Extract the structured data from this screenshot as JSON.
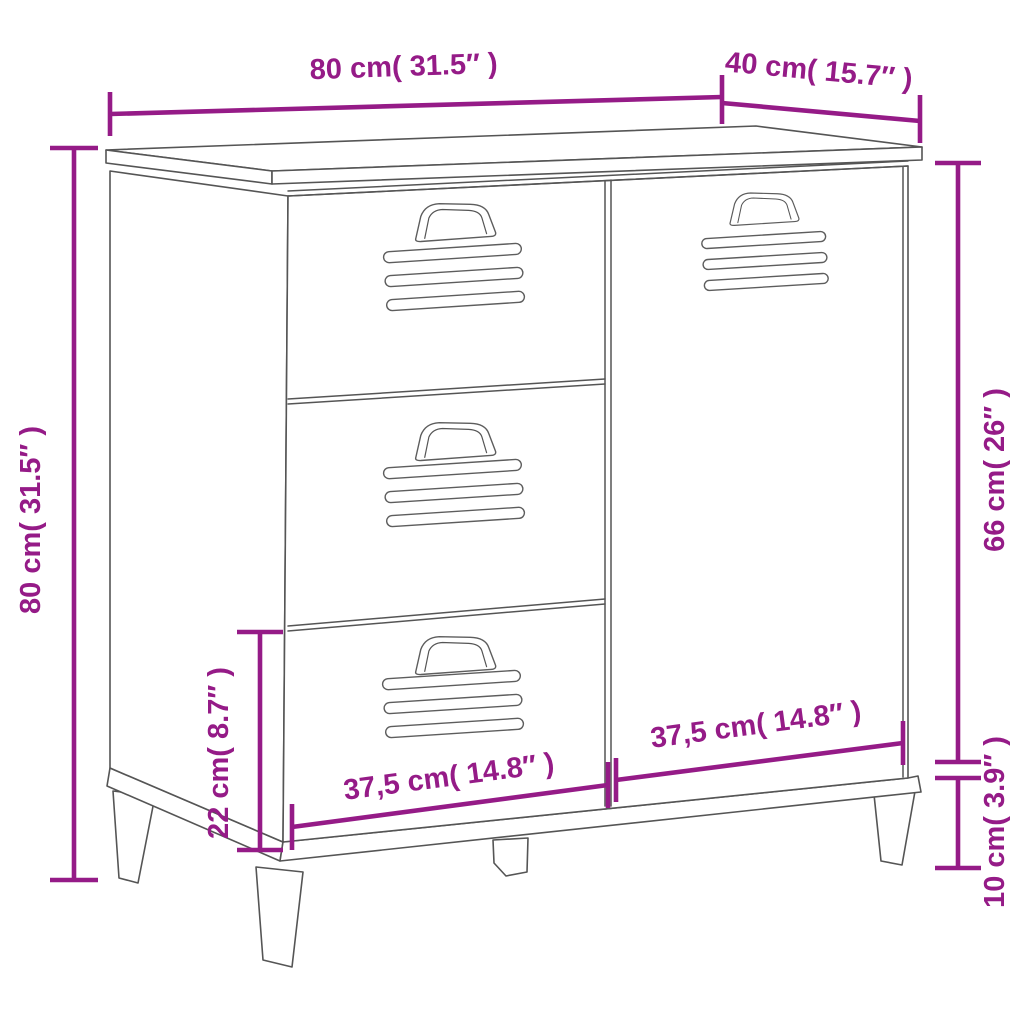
{
  "page": {
    "title": "Cabinet dimension diagram",
    "background_color": "#ffffff",
    "accent_color": "#951B87",
    "line_color": "#555555"
  },
  "product": {
    "description": "Industrial sideboard line drawing with three vented drawers on the left, one vented door on the right, and four splayed legs"
  },
  "dimensions": {
    "top_width": {
      "label": "80 cm( 31.5″ )",
      "cm": "80",
      "inch": "31.5"
    },
    "top_depth": {
      "label": "40 cm( 15.7″ )",
      "cm": "40",
      "inch": "15.7"
    },
    "left_height": {
      "label": "80 cm( 31.5″ )",
      "cm": "80",
      "inch": "31.5"
    },
    "right_upper_height": {
      "label": "66 cm( 26″ )",
      "cm": "66",
      "inch": "26"
    },
    "right_leg_height": {
      "label": "10 cm( 3.9″ )",
      "cm": "10",
      "inch": "3.9"
    },
    "left_bottom_drawer_height": {
      "label": "22 cm( 8.7″ )",
      "cm": "22",
      "inch": "8.7"
    },
    "bottom_drawer_width": {
      "label": "37,5 cm( 14.8″ )",
      "cm": "37,5",
      "inch": "14.8"
    },
    "bottom_door_width": {
      "label": "37,5 cm( 14.8″ )",
      "cm": "37,5",
      "inch": "14.8"
    }
  }
}
